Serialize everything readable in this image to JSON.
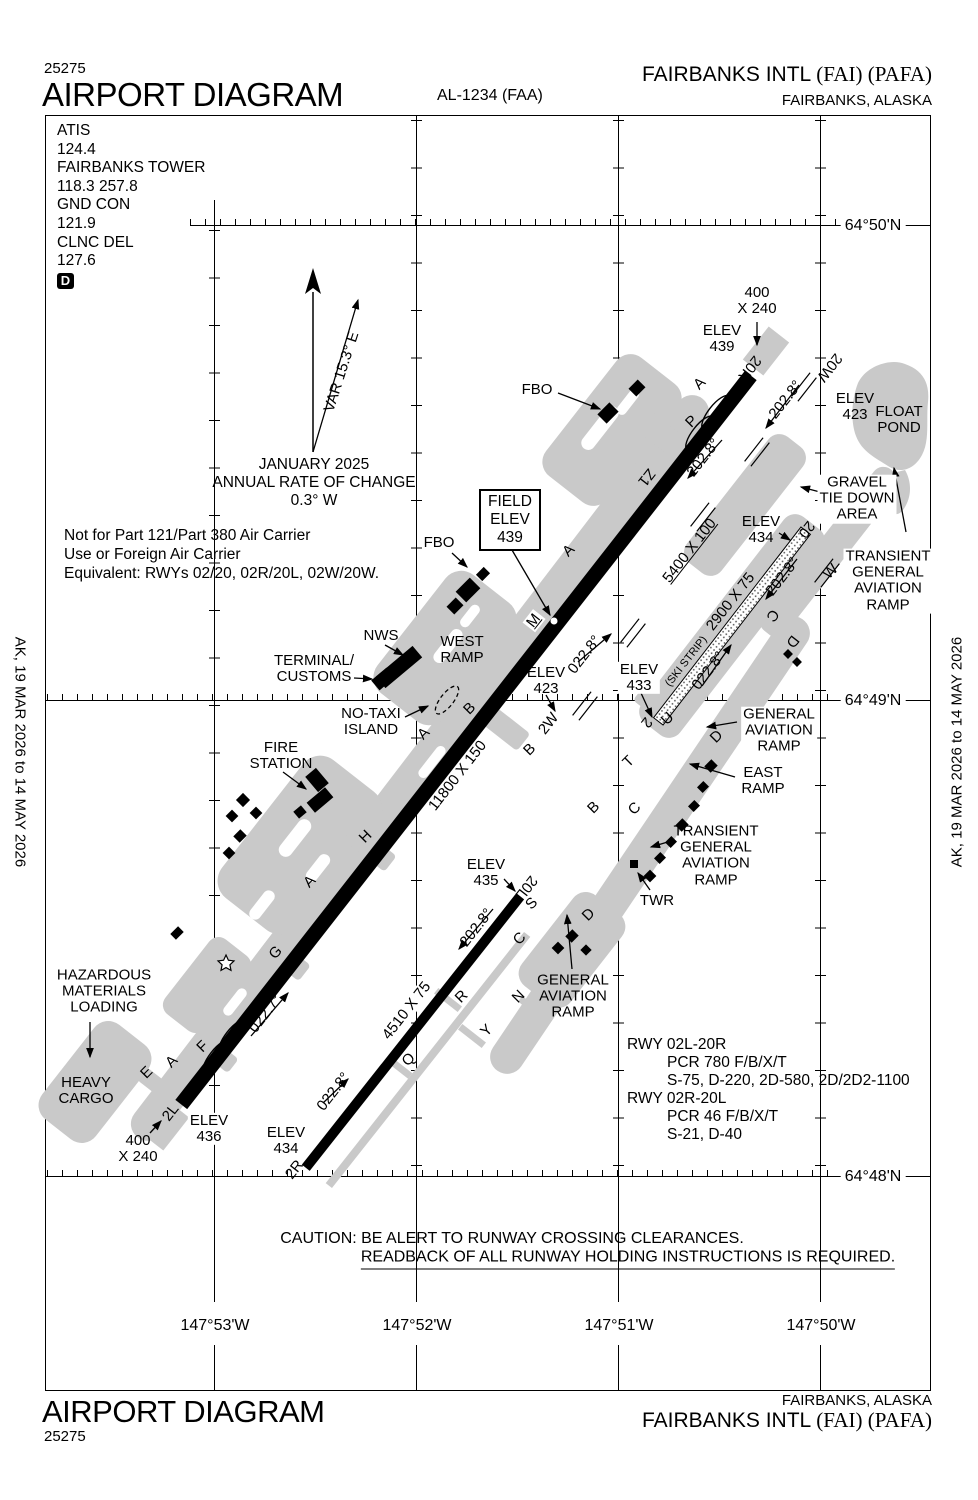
{
  "header": {
    "chart_code_top": "25275",
    "title": "AIRPORT DIAGRAM",
    "procedure_id": "AL-1234 (FAA)",
    "airport_name": "FAIRBANKS INTL",
    "airport_codes": "(FAI) (PAFA)",
    "city": "FAIRBANKS, ALASKA"
  },
  "footer": {
    "title": "AIRPORT DIAGRAM",
    "chart_code": "25275",
    "city": "FAIRBANKS, ALASKA",
    "airport_name": "FAIRBANKS INTL",
    "airport_codes": "(FAI) (PAFA)"
  },
  "effective_dates": "AK,  19 MAR 2026  to  14 MAY 2026",
  "comms": {
    "lines": [
      "ATIS",
      "124.4",
      "FAIRBANKS TOWER",
      "118.3  257.8",
      "GND CON",
      "121.9",
      "CLNC DEL",
      "127.6"
    ],
    "atis_symbol": "D"
  },
  "notes": [
    "Not for Part 121/Part 380 Air Carrier",
    "Use or Foreign Air Carrier",
    "Equivalent: RWYs 02/20, 02R/20L, 02W/20W."
  ],
  "magnetic_variation": {
    "label": "VAR 15.3° E",
    "date": "JANUARY 2025",
    "rate_label": "ANNUAL RATE OF CHANGE",
    "rate_value": "0.3° W"
  },
  "field_elevation": {
    "line1": "FIELD",
    "line2": "ELEV",
    "line3": "439"
  },
  "caution": {
    "line1": "CAUTION: BE ALERT TO RUNWAY CROSSING CLEARANCES.",
    "line2": "READBACK OF ALL RUNWAY HOLDING INSTRUCTIONS IS REQUIRED."
  },
  "runway_data": [
    {
      "text": "RWY 02L-20R",
      "indent": 0
    },
    {
      "text": "PCR 780 F/B/X/T",
      "indent": 1
    },
    {
      "text": "S-75, D-220, 2D-580, 2D/2D2-1100",
      "indent": 1
    },
    {
      "text": "RWY 02R-20L",
      "indent": 0
    },
    {
      "text": "PCR 46 F/B/X/T",
      "indent": 1
    },
    {
      "text": "S-21, D-40",
      "indent": 1
    }
  ],
  "grid": {
    "latitudes": [
      {
        "label": "64°50'N",
        "y": 226
      },
      {
        "label": "64°49'N",
        "y": 701
      },
      {
        "label": "64°48'N",
        "y": 1177
      }
    ],
    "longitudes": [
      {
        "label": "147°53'W",
        "x": 215
      },
      {
        "label": "147°52'W",
        "x": 417
      },
      {
        "label": "147°51'W",
        "x": 619
      },
      {
        "label": "147°50'W",
        "x": 821
      }
    ]
  },
  "colors": {
    "ink": "#000000",
    "apron_gray": "#c9c9c9",
    "paper": "#ffffff"
  },
  "map_labels": [
    {
      "name": "var-label",
      "t": "VAR 15.3° E",
      "x": 342,
      "y": 372,
      "rot": -72
    },
    {
      "name": "fbo-north-label",
      "t": "FBO",
      "x": 537,
      "y": 390
    },
    {
      "name": "rwy20r-overrun-dims",
      "t": "400\nX 240",
      "x": 757,
      "y": 301
    },
    {
      "name": "rwy20r-elev",
      "t": "ELEV\n439",
      "x": 722,
      "y": 339
    },
    {
      "name": "rwy20r-number",
      "t": "20R",
      "x": 749,
      "y": 368,
      "rot": 128
    },
    {
      "name": "waterlane-20w-number",
      "t": "20W",
      "x": 829,
      "y": 367,
      "rot": 128
    },
    {
      "name": "waterlane-heading-south",
      "t": "202.8°",
      "x": 786,
      "y": 400,
      "rot": -52
    },
    {
      "name": "float-pond-elev",
      "t": "ELEV\n423",
      "x": 855,
      "y": 407
    },
    {
      "name": "float-pond-label",
      "t": "FLOAT\nPOND",
      "x": 899,
      "y": 420
    },
    {
      "name": "gravel-tie-down-label",
      "t": "GRAVEL\nTIE DOWN\nAREA",
      "x": 857,
      "y": 499,
      "bg": 1
    },
    {
      "name": "transient-ga-ramp-ne-label",
      "t": "TRANSIENT\nGENERAL\nAVIATION\nRAMP",
      "x": 888,
      "y": 581,
      "bg": 1
    },
    {
      "name": "waterlane-dims",
      "t": "5400 X 100",
      "x": 690,
      "y": 551,
      "rot": -52,
      "u": 1
    },
    {
      "name": "rwy02l-heading-north",
      "t": "202.8°",
      "x": 704,
      "y": 458,
      "rot": -52
    },
    {
      "name": "taxiway-z1",
      "t": "Z1",
      "x": 646,
      "y": 477,
      "rot": 128
    },
    {
      "name": "taxiway-a-north",
      "t": "A",
      "x": 700,
      "y": 384,
      "rot": -45
    },
    {
      "name": "taxiway-p",
      "t": "P",
      "x": 692,
      "y": 422,
      "rot": -45
    },
    {
      "name": "ski-strip-elev-north",
      "t": "ELEV\n434",
      "x": 761,
      "y": 530
    },
    {
      "name": "ski-strip-20-number",
      "t": "20",
      "x": 806,
      "y": 529,
      "rot": 128
    },
    {
      "name": "ski-strip-heading-south",
      "t": "202.8°",
      "x": 783,
      "y": 577,
      "rot": -52
    },
    {
      "name": "ski-strip-dims",
      "t": "2900 X 75",
      "x": 731,
      "y": 602,
      "rot": -52
    },
    {
      "name": "ski-strip-label",
      "t": "(SKI STRIP)",
      "x": 687,
      "y": 662,
      "rot": -52,
      "size": 11
    },
    {
      "name": "ski-strip-heading-north",
      "t": "022.8°",
      "x": 709,
      "y": 671,
      "rot": -52
    },
    {
      "name": "taxiway-c-ski",
      "t": "C",
      "x": 772,
      "y": 615,
      "rot": 128
    },
    {
      "name": "taxiway-d-ski",
      "t": "D",
      "x": 792,
      "y": 641,
      "rot": 128
    },
    {
      "name": "taxiway-w",
      "t": "W",
      "x": 831,
      "y": 572,
      "rot": -45
    },
    {
      "name": "fbo-west-label",
      "t": "FBO",
      "x": 439,
      "y": 543
    },
    {
      "name": "taxiway-a-mid",
      "t": "A",
      "x": 569,
      "y": 551,
      "rot": -45
    },
    {
      "name": "taxiway-m",
      "t": "M",
      "x": 534,
      "y": 621,
      "rot": -52,
      "bg": 1,
      "u": 1
    },
    {
      "name": "nws-label",
      "t": "NWS",
      "x": 381,
      "y": 636
    },
    {
      "name": "terminal-customs-label",
      "t": "TERMINAL/\nCUSTOMS",
      "x": 314,
      "y": 669
    },
    {
      "name": "west-ramp-label",
      "t": "WEST\nRAMP",
      "x": 462,
      "y": 650
    },
    {
      "name": "rwy02l-elev-mid",
      "t": "ELEV\n423",
      "x": 546,
      "y": 681
    },
    {
      "name": "rwy02l-heading-mid",
      "t": "022.8°",
      "x": 585,
      "y": 655,
      "rot": -52
    },
    {
      "name": "ski-strip-elev-south",
      "t": "ELEV\n433",
      "x": 639,
      "y": 678,
      "bg": 1
    },
    {
      "name": "waterlane-2w-number",
      "t": "2W",
      "x": 549,
      "y": 724,
      "rot": -52
    },
    {
      "name": "ski-strip-2-number",
      "t": "2",
      "x": 646,
      "y": 722,
      "rot": 128
    },
    {
      "name": "taxiway-u",
      "t": "U",
      "x": 668,
      "y": 719,
      "rot": -45
    },
    {
      "name": "no-taxi-island-label",
      "t": "NO-TAXI\nISLAND",
      "x": 371,
      "y": 722
    },
    {
      "name": "taxiway-b-west",
      "t": "B",
      "x": 470,
      "y": 709,
      "rot": -45
    },
    {
      "name": "taxiway-a-south",
      "t": "A",
      "x": 424,
      "y": 734,
      "rot": -45
    },
    {
      "name": "taxiway-b-mid",
      "t": "B",
      "x": 530,
      "y": 750,
      "rot": -45
    },
    {
      "name": "rwy02l-dims",
      "t": "11800 X 150",
      "x": 458,
      "y": 776,
      "rot": -52
    },
    {
      "name": "taxiway-b-east",
      "t": "B",
      "x": 594,
      "y": 808,
      "rot": -45
    },
    {
      "name": "taxiway-t",
      "t": "T",
      "x": 629,
      "y": 762,
      "rot": -45
    },
    {
      "name": "taxiway-c-mid",
      "t": "C",
      "x": 635,
      "y": 809,
      "rot": -45
    },
    {
      "name": "taxiway-d-north",
      "t": "D",
      "x": 717,
      "y": 737,
      "rot": -45
    },
    {
      "name": "ga-ramp-east-label",
      "t": "GENERAL\nAVIATION\nRAMP",
      "x": 779,
      "y": 731,
      "bg": 1
    },
    {
      "name": "east-ramp-label",
      "t": "EAST\nRAMP",
      "x": 763,
      "y": 781
    },
    {
      "name": "transient-ga-ramp-label",
      "t": "TRANSIENT\nGENERAL\nAVIATION\nRAMP",
      "x": 716,
      "y": 856
    },
    {
      "name": "twr-label",
      "t": "TWR",
      "x": 657,
      "y": 901
    },
    {
      "name": "fire-station-label",
      "t": "FIRE\nSTATION",
      "x": 281,
      "y": 756
    },
    {
      "name": "taxiway-h",
      "t": "H",
      "x": 366,
      "y": 837,
      "rot": -45
    },
    {
      "name": "taxiway-a-sw",
      "t": "A",
      "x": 310,
      "y": 882,
      "rot": -45
    },
    {
      "name": "taxiway-g",
      "t": "G",
      "x": 276,
      "y": 953,
      "rot": -45
    },
    {
      "name": "rwy02l-heading-south",
      "t": "022.7°",
      "x": 266,
      "y": 1014,
      "rot": -52
    },
    {
      "name": "hazmat-label",
      "t": "HAZARDOUS\nMATERIALS\nLOADING",
      "x": 104,
      "y": 992
    },
    {
      "name": "heavy-cargo-label",
      "t": "HEAVY\nCARGO",
      "x": 86,
      "y": 1091
    },
    {
      "name": "taxiway-f",
      "t": "F",
      "x": 203,
      "y": 1047,
      "rot": -45
    },
    {
      "name": "taxiway-a-f",
      "t": "A",
      "x": 172,
      "y": 1062,
      "rot": -45
    },
    {
      "name": "taxiway-e",
      "t": "E",
      "x": 147,
      "y": 1073,
      "rot": -45
    },
    {
      "name": "rwy02l-number",
      "t": "2L",
      "x": 171,
      "y": 1113,
      "rot": -52
    },
    {
      "name": "rwy02l-elev-south",
      "t": "ELEV\n436",
      "x": 209,
      "y": 1129,
      "bg": 1
    },
    {
      "name": "rwy02l-overrun-dims",
      "t": "400\nX 240",
      "x": 138,
      "y": 1149
    },
    {
      "name": "rwy02r-elev-south",
      "t": "ELEV\n434",
      "x": 286,
      "y": 1141
    },
    {
      "name": "rwy02r-number",
      "t": "2R",
      "x": 295,
      "y": 1170,
      "rot": -52
    },
    {
      "name": "rwy02r-heading-south",
      "t": "022.8°",
      "x": 334,
      "y": 1092,
      "rot": -52
    },
    {
      "name": "rwy20l-elev",
      "t": "ELEV\n435",
      "x": 486,
      "y": 873
    },
    {
      "name": "rwy20l-number",
      "t": "20L",
      "x": 526,
      "y": 887,
      "rot": 128
    },
    {
      "name": "taxiway-s",
      "t": "S",
      "x": 532,
      "y": 904,
      "rot": -45
    },
    {
      "name": "rwy02r-heading-north",
      "t": "202.8°",
      "x": 477,
      "y": 928,
      "rot": -52
    },
    {
      "name": "taxiway-c-south",
      "t": "C",
      "x": 520,
      "y": 939,
      "rot": -45
    },
    {
      "name": "taxiway-d-south",
      "t": "D",
      "x": 589,
      "y": 915,
      "rot": -45
    },
    {
      "name": "ga-ramp-south-label",
      "t": "GENERAL\nAVIATION\nRAMP",
      "x": 573,
      "y": 997
    },
    {
      "name": "taxiway-n",
      "t": "N",
      "x": 519,
      "y": 997,
      "rot": -45
    },
    {
      "name": "taxiway-r",
      "t": "R",
      "x": 462,
      "y": 997,
      "rot": -45
    },
    {
      "name": "taxiway-y",
      "t": "Y",
      "x": 487,
      "y": 1031,
      "rot": -45
    },
    {
      "name": "taxiway-q",
      "t": "Q",
      "x": 409,
      "y": 1060,
      "rot": -45
    },
    {
      "name": "rwy02r-dims",
      "t": "4510 X 75",
      "x": 407,
      "y": 1011,
      "rot": -52,
      "bg": 1
    }
  ]
}
